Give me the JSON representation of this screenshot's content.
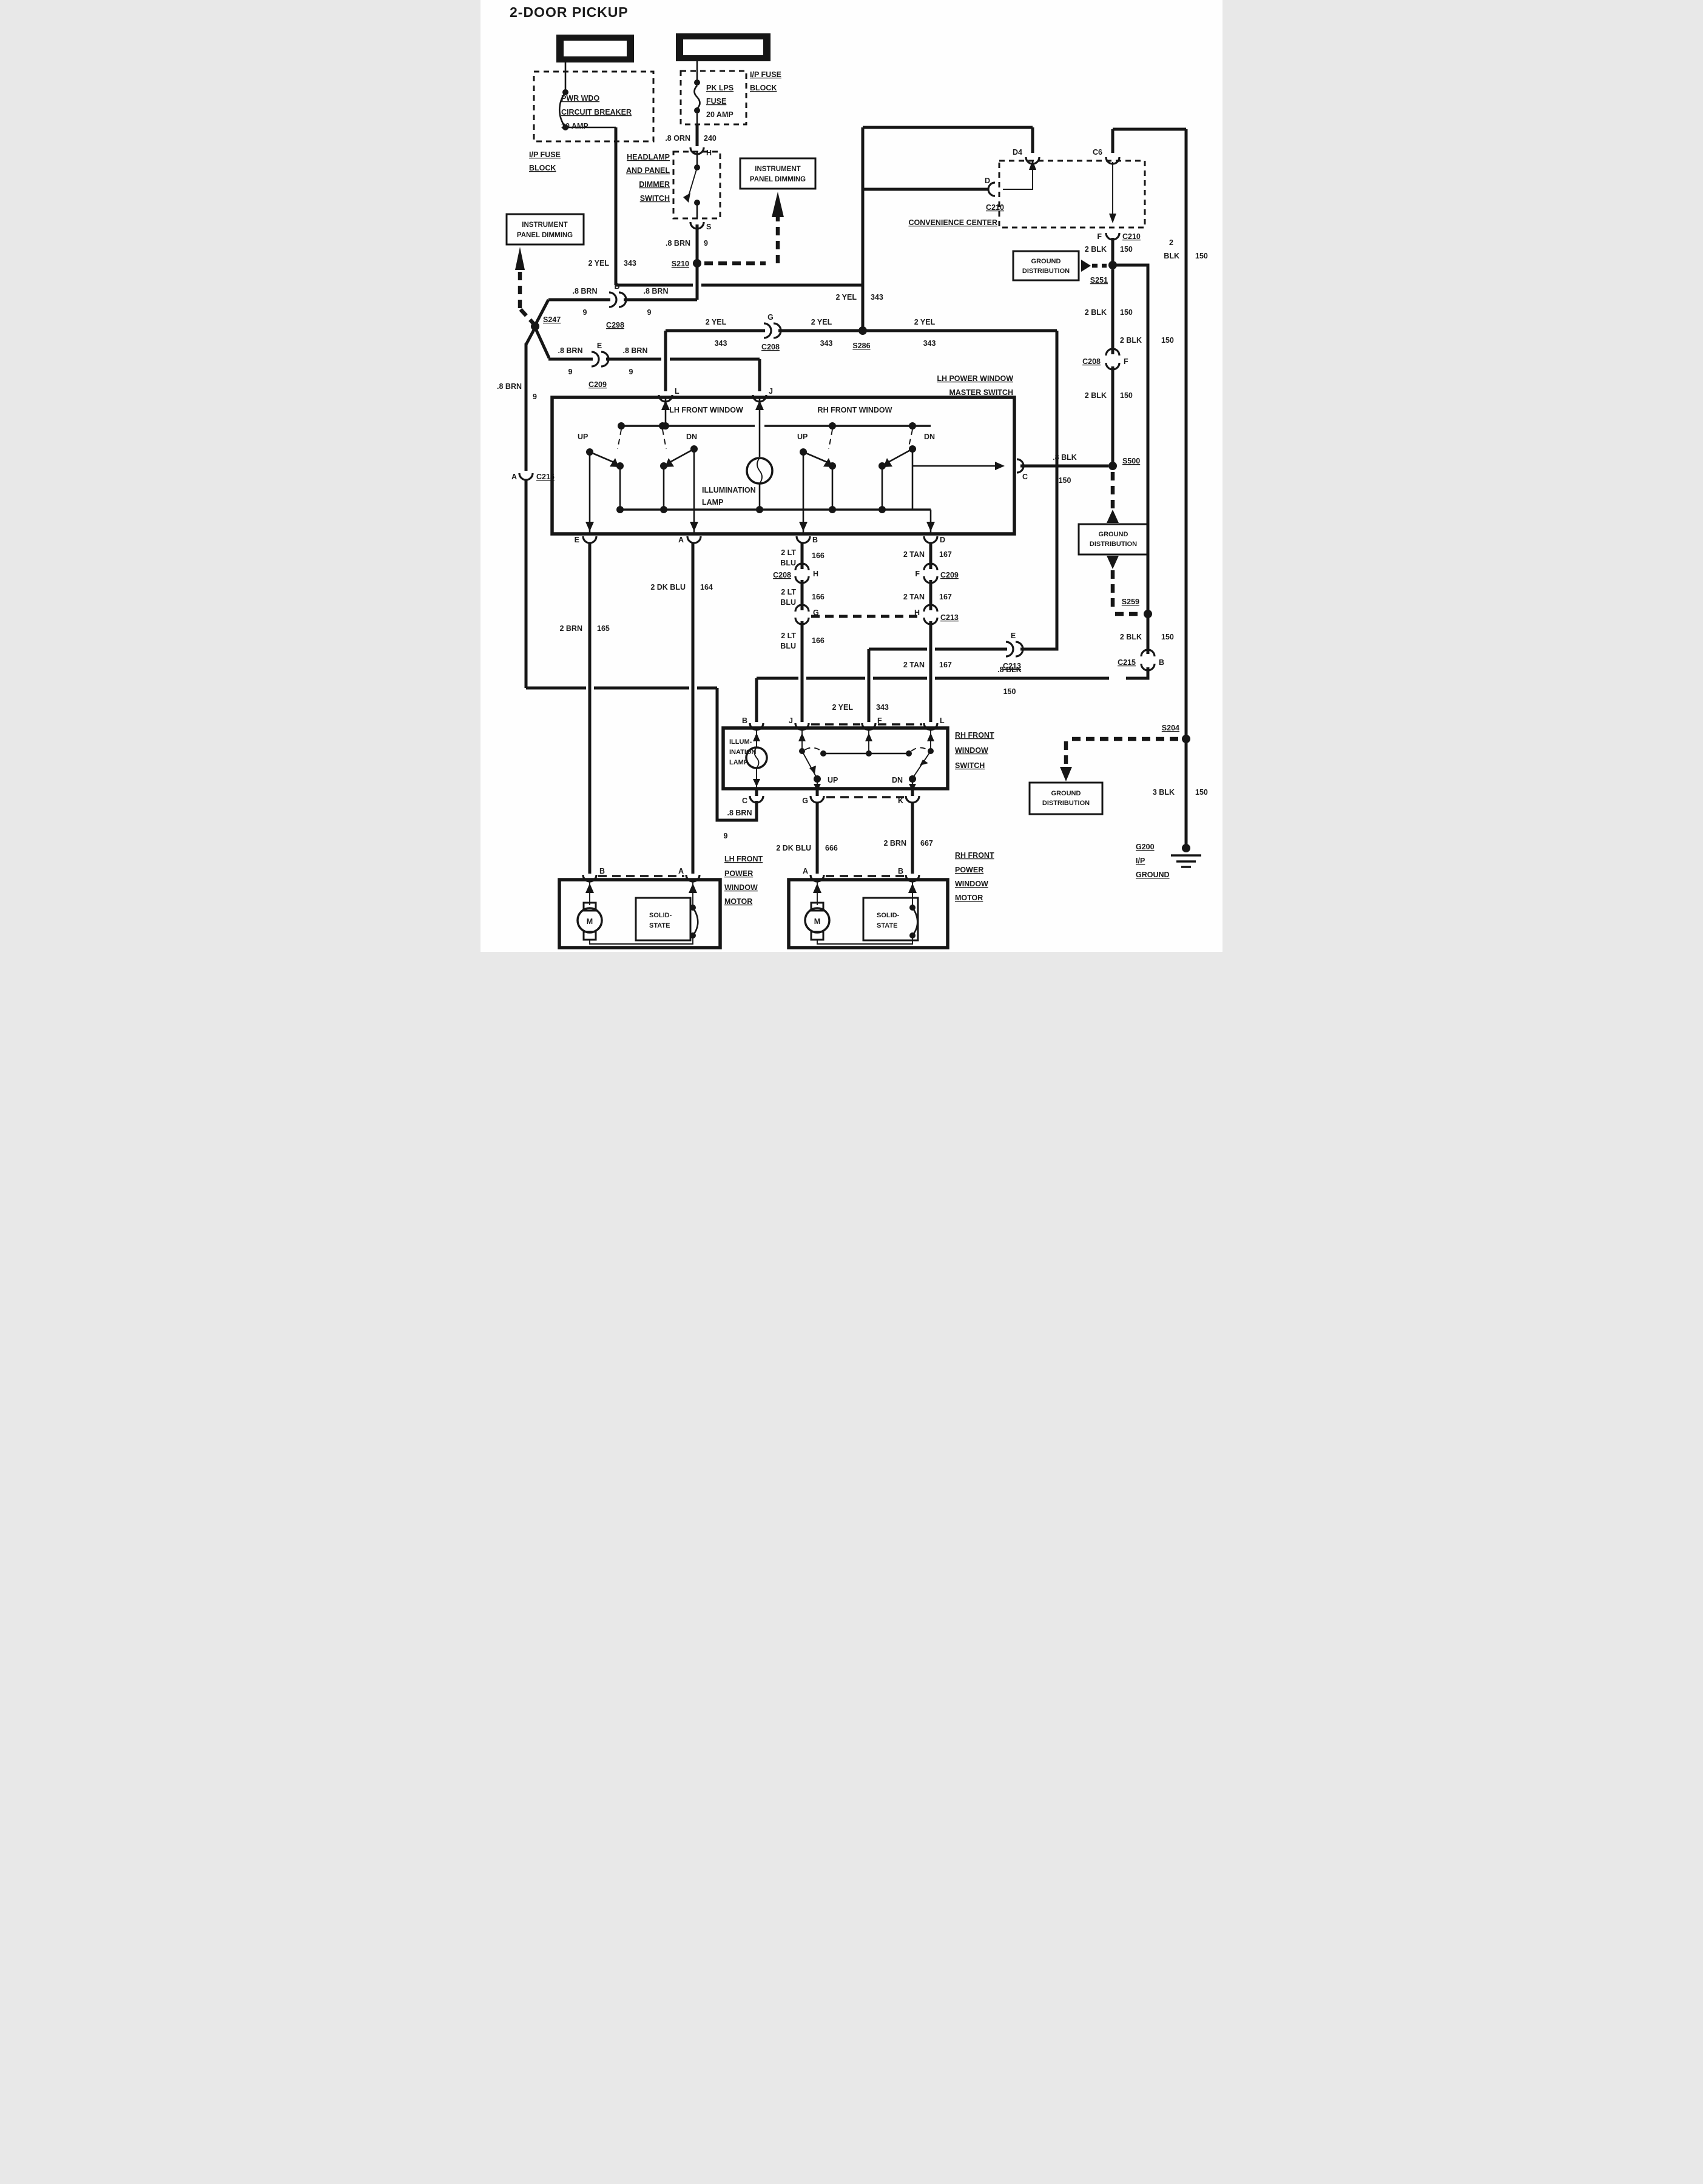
{
  "title": "2-DOOR PICKUP",
  "tokens": {
    "yel": "2 YEL",
    "c343": "343",
    "brn8": ".8 BRN",
    "n9": "9",
    "blk2": "2 BLK",
    "c150": "150",
    "blk8": ".8 BLK",
    "lt2": "2 LT",
    "blu": "BLU",
    "c166": "166",
    "tan2": "2 TAN",
    "c167": "167",
    "brn2": "2 BRN",
    "c165": "165",
    "dkblu": "2 DK BLU",
    "c164": "164",
    "c666": "666",
    "c667": "667",
    "blk3": "3 BLK",
    "orn8": ".8 ORN",
    "c240": "240",
    "n2": "2",
    "blk": "BLK",
    "up": "UP",
    "dn": "DN",
    "m": "M"
  },
  "pins": {
    "a": "A",
    "b": "B",
    "c": "C",
    "d": "D",
    "e": "E",
    "f": "F",
    "g": "G",
    "h": "H",
    "j": "J",
    "k": "K",
    "l": "L",
    "s": "S",
    "d4": "D4",
    "c6": "C6"
  },
  "connectors": {
    "c298": "C298",
    "c209": "C209",
    "c208": "C208",
    "c210": "C210",
    "c213": "C213",
    "c215": "C215"
  },
  "splices": {
    "s210": "S210",
    "s247": "S247",
    "s286": "S286",
    "s251": "S251",
    "s500": "S500",
    "s259": "S259",
    "s204": "S204"
  },
  "boxes": {
    "hot_in_run": "HOT IN RUN",
    "hot_at_all_times": "HOT AT ALL TIMES",
    "ipd": [
      "INSTRUMENT",
      "PANEL DIMMING"
    ],
    "ip_fuse_block": [
      "I/P FUSE",
      "BLOCK"
    ],
    "breaker": [
      "PWR WDO",
      "CIRCUIT BREAKER",
      "30 AMP"
    ],
    "fuse": [
      "PK LPS",
      "FUSE",
      "20 AMP"
    ],
    "dimmer_switch": [
      "HEADLAMP",
      "AND PANEL",
      "DIMMER",
      "SWITCH"
    ],
    "conv_center": "CONVENIENCE CENTER",
    "gnd_dist": [
      "GROUND",
      "DISTRIBUTION"
    ],
    "master": [
      "LH POWER WINDOW",
      "MASTER SWITCH"
    ],
    "lh_front_window": "LH FRONT WINDOW",
    "rh_front_window": "RH FRONT WINDOW",
    "illum": [
      "ILLUMINATION",
      "LAMP"
    ],
    "illum_s": [
      "ILLUM-",
      "INATION",
      "LAMP"
    ],
    "rh_switch": [
      "RH FRONT",
      "WINDOW",
      "SWITCH"
    ],
    "lh_motor": [
      "LH FRONT",
      "POWER",
      "WINDOW",
      "MOTOR"
    ],
    "rh_motor": [
      "RH FRONT",
      "POWER",
      "WINDOW",
      "MOTOR"
    ],
    "solid_state": [
      "SOLID-",
      "STATE"
    ],
    "g200": [
      "G200",
      "I/P",
      "GROUND"
    ]
  }
}
